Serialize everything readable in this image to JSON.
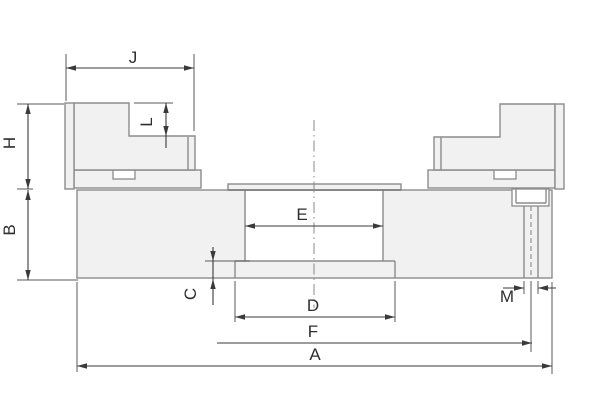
{
  "drawing": {
    "type": "technical-cross-section",
    "labels": {
      "J": "J",
      "H": "H",
      "L": "L",
      "B": "B",
      "E": "E",
      "C": "C",
      "D": "D",
      "F": "F",
      "A": "A",
      "M": "M"
    },
    "colors": {
      "part_fill": "#f1f1f2",
      "part_line": "#8c8c8c",
      "dim_line": "#3a3a3a",
      "text": "#2e2e2e",
      "background": "#ffffff",
      "centerline": "#888888"
    }
  }
}
